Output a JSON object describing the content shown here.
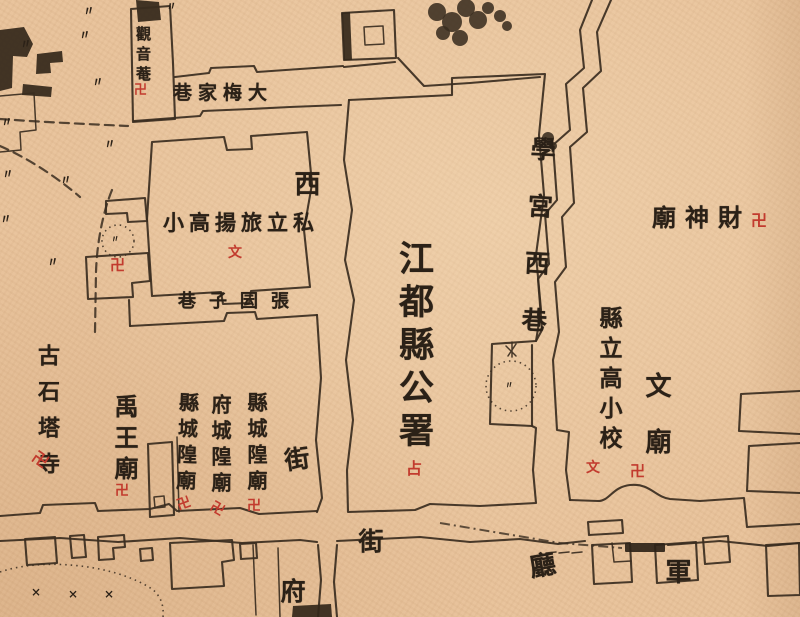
{
  "canvas": {
    "width": 800,
    "height": 617,
    "paper_color": "#e9c49d",
    "ink_color": "#2b2117",
    "red_color": "#c23b2e",
    "description": "historical hand-drawn chinese city map, jiangdu county seat area"
  },
  "labels": [
    {
      "id": "guanyin-an",
      "text": "觀音菴",
      "dir": "v",
      "x": 135,
      "y": 26,
      "size": 15,
      "spacing": 5,
      "color": "ink"
    },
    {
      "id": "dameijia-lane",
      "text": "巷家梅大",
      "reading": "大梅家巷",
      "dir": "h",
      "x": 173,
      "y": 84,
      "size": 19,
      "spacing": 6,
      "color": "ink"
    },
    {
      "id": "xi-char",
      "text": "西",
      "dir": "v",
      "x": 292,
      "y": 170,
      "size": 26,
      "spacing": 0,
      "color": "ink"
    },
    {
      "id": "lvyang-school",
      "text": "小高揚旅立私",
      "reading": "私立旅揚高小",
      "dir": "h",
      "x": 163,
      "y": 212,
      "size": 21,
      "spacing": 5,
      "color": "ink"
    },
    {
      "id": "zhangyuanzi-lane",
      "text": "巷子囩張",
      "reading": "張囩子巷",
      "dir": "h",
      "x": 178,
      "y": 293,
      "size": 18,
      "spacing": 13,
      "color": "ink"
    },
    {
      "id": "jiangdu-county-office",
      "text": "江都縣公署",
      "dir": "v",
      "x": 396,
      "y": 240,
      "size": 35,
      "spacing": 8,
      "color": "ink"
    },
    {
      "id": "xuegong-west-lane",
      "text": "學宮西巷",
      "dir": "v",
      "x": 524,
      "y": 136,
      "size": 25,
      "spacing": 32,
      "rot": 3,
      "color": "ink"
    },
    {
      "id": "caishen-temple",
      "text": "廟神財",
      "reading": "財神廟",
      "dir": "h",
      "x": 652,
      "y": 206,
      "size": 24,
      "spacing": 9,
      "color": "ink"
    },
    {
      "id": "county-higher-primary",
      "text": "縣立高小校",
      "dir": "v",
      "x": 597,
      "y": 306,
      "size": 23,
      "spacing": 7,
      "color": "ink"
    },
    {
      "id": "wen-miao",
      "text": "文廟",
      "dir": "v",
      "x": 643,
      "y": 372,
      "size": 26,
      "spacing": 30,
      "color": "ink"
    },
    {
      "id": "gushita-temple",
      "text": "古石塔寺",
      "dir": "v",
      "x": 36,
      "y": 344,
      "size": 22,
      "spacing": 14,
      "color": "ink"
    },
    {
      "id": "yuwang-temple",
      "text": "禹王廟",
      "dir": "v",
      "x": 112,
      "y": 394,
      "size": 24,
      "spacing": 7,
      "color": "ink"
    },
    {
      "id": "xian-chenghuang-right",
      "text": "縣城隍廟",
      "dir": "v",
      "x": 246,
      "y": 392,
      "size": 20,
      "spacing": 6,
      "color": "ink"
    },
    {
      "id": "fu-chenghuang",
      "text": "府城隍廟",
      "dir": "v",
      "x": 210,
      "y": 394,
      "size": 20,
      "spacing": 6,
      "color": "ink"
    },
    {
      "id": "xian-chenghuang-left",
      "text": "縣城隍廟",
      "dir": "v",
      "x": 176,
      "y": 392,
      "size": 20,
      "spacing": 6,
      "rot": 2,
      "color": "ink"
    },
    {
      "id": "street-char-jie-1",
      "text": "街",
      "dir": "v",
      "x": 283,
      "y": 446,
      "size": 25,
      "spacing": 0,
      "rot": -8,
      "color": "ink"
    },
    {
      "id": "street-char-fu",
      "text": "府",
      "dir": "v",
      "x": 279,
      "y": 578,
      "size": 25,
      "spacing": 0,
      "color": "ink"
    },
    {
      "id": "street-char-jie-2",
      "text": "街",
      "dir": "v",
      "x": 357,
      "y": 528,
      "size": 25,
      "spacing": 0,
      "color": "ink"
    },
    {
      "id": "street-char-ting",
      "text": "廳",
      "dir": "v",
      "x": 527,
      "y": 552,
      "size": 26,
      "spacing": 0,
      "rot": -10,
      "color": "ink"
    },
    {
      "id": "street-char-jun",
      "text": "軍",
      "dir": "v",
      "x": 663,
      "y": 558,
      "size": 26,
      "spacing": 0,
      "color": "ink"
    }
  ],
  "symbols": [
    {
      "id": "swastika-guanyin",
      "glyph": "卍",
      "x": 134,
      "y": 84,
      "size": 13,
      "color": "red"
    },
    {
      "id": "school-mark-lvyang",
      "glyph": "文",
      "x": 228,
      "y": 246,
      "size": 14,
      "color": "red"
    },
    {
      "id": "swastika-west-building",
      "glyph": "卍",
      "x": 110,
      "y": 258,
      "size": 15,
      "color": "red"
    },
    {
      "id": "office-mark-gongshu",
      "glyph": "占",
      "x": 406,
      "y": 461,
      "size": 16,
      "color": "red"
    },
    {
      "id": "swastika-caishen",
      "glyph": "卍",
      "x": 751,
      "y": 213,
      "size": 16,
      "color": "red"
    },
    {
      "id": "school-mark-xianli",
      "glyph": "文",
      "x": 586,
      "y": 461,
      "size": 14,
      "color": "red"
    },
    {
      "id": "swastika-wenmiao",
      "glyph": "卍",
      "x": 630,
      "y": 464,
      "size": 15,
      "color": "red"
    },
    {
      "id": "swastika-gushita",
      "glyph": "卍",
      "x": 32,
      "y": 452,
      "size": 16,
      "rot": 35,
      "color": "red"
    },
    {
      "id": "swastika-yuwang",
      "glyph": "卍",
      "x": 115,
      "y": 484,
      "size": 14,
      "color": "red"
    },
    {
      "id": "swastika-chenghuang-r",
      "glyph": "卍",
      "x": 247,
      "y": 499,
      "size": 14,
      "color": "red"
    },
    {
      "id": "swastika-chenghuang-m",
      "glyph": "卍",
      "x": 210,
      "y": 502,
      "size": 14,
      "rot": 30,
      "color": "red"
    },
    {
      "id": "swastika-chenghuang-l",
      "glyph": "卍",
      "x": 177,
      "y": 497,
      "size": 14,
      "rot": -20,
      "color": "red"
    },
    {
      "id": "grass-tuft-1",
      "glyph": "〃",
      "x": 83,
      "y": 5,
      "size": 12,
      "rot": -10,
      "color": "ink"
    },
    {
      "id": "grass-tuft-2",
      "glyph": "〃",
      "x": 166,
      "y": 1,
      "size": 11,
      "rot": -10,
      "color": "ink"
    },
    {
      "id": "grass-tuft-3",
      "glyph": "〃",
      "x": 20,
      "y": 38,
      "size": 12,
      "rot": -10,
      "color": "ink"
    },
    {
      "id": "grass-tuft-4",
      "glyph": "〃",
      "x": 79,
      "y": 29,
      "size": 12,
      "rot": -10,
      "color": "ink"
    },
    {
      "id": "grass-tuft-5",
      "glyph": "〃",
      "x": 92,
      "y": 76,
      "size": 12,
      "rot": -10,
      "color": "ink"
    },
    {
      "id": "grass-tuft-6",
      "glyph": "〃",
      "x": 1,
      "y": 116,
      "size": 12,
      "rot": -10,
      "color": "ink"
    },
    {
      "id": "grass-tuft-7",
      "glyph": "〃",
      "x": 104,
      "y": 138,
      "size": 12,
      "rot": -10,
      "color": "ink"
    },
    {
      "id": "grass-tuft-8",
      "glyph": "〃",
      "x": 2,
      "y": 168,
      "size": 12,
      "rot": -10,
      "color": "ink"
    },
    {
      "id": "grass-tuft-9",
      "glyph": "〃",
      "x": 60,
      "y": 174,
      "size": 12,
      "rot": -10,
      "color": "ink"
    },
    {
      "id": "grass-tuft-10",
      "glyph": "〃",
      "x": 47,
      "y": 256,
      "size": 12,
      "rot": -10,
      "color": "ink"
    },
    {
      "id": "grass-tuft-11",
      "glyph": "〃",
      "x": 0,
      "y": 213,
      "size": 12,
      "rot": -10,
      "color": "ink"
    },
    {
      "id": "grass-tuft-circle-west",
      "glyph": "〃",
      "x": 111,
      "y": 236,
      "size": 9,
      "rot": -10,
      "color": "ink"
    },
    {
      "id": "grass-tuft-circle-east",
      "glyph": "〃",
      "x": 505,
      "y": 382,
      "size": 9,
      "rot": -10,
      "color": "ink"
    },
    {
      "id": "garden-cross-1",
      "glyph": "×",
      "x": 31,
      "y": 586,
      "size": 12,
      "color": "ink"
    },
    {
      "id": "garden-cross-2",
      "glyph": "×",
      "x": 68,
      "y": 588,
      "size": 12,
      "color": "ink"
    },
    {
      "id": "garden-cross-3",
      "glyph": "×",
      "x": 104,
      "y": 588,
      "size": 12,
      "color": "ink"
    }
  ]
}
